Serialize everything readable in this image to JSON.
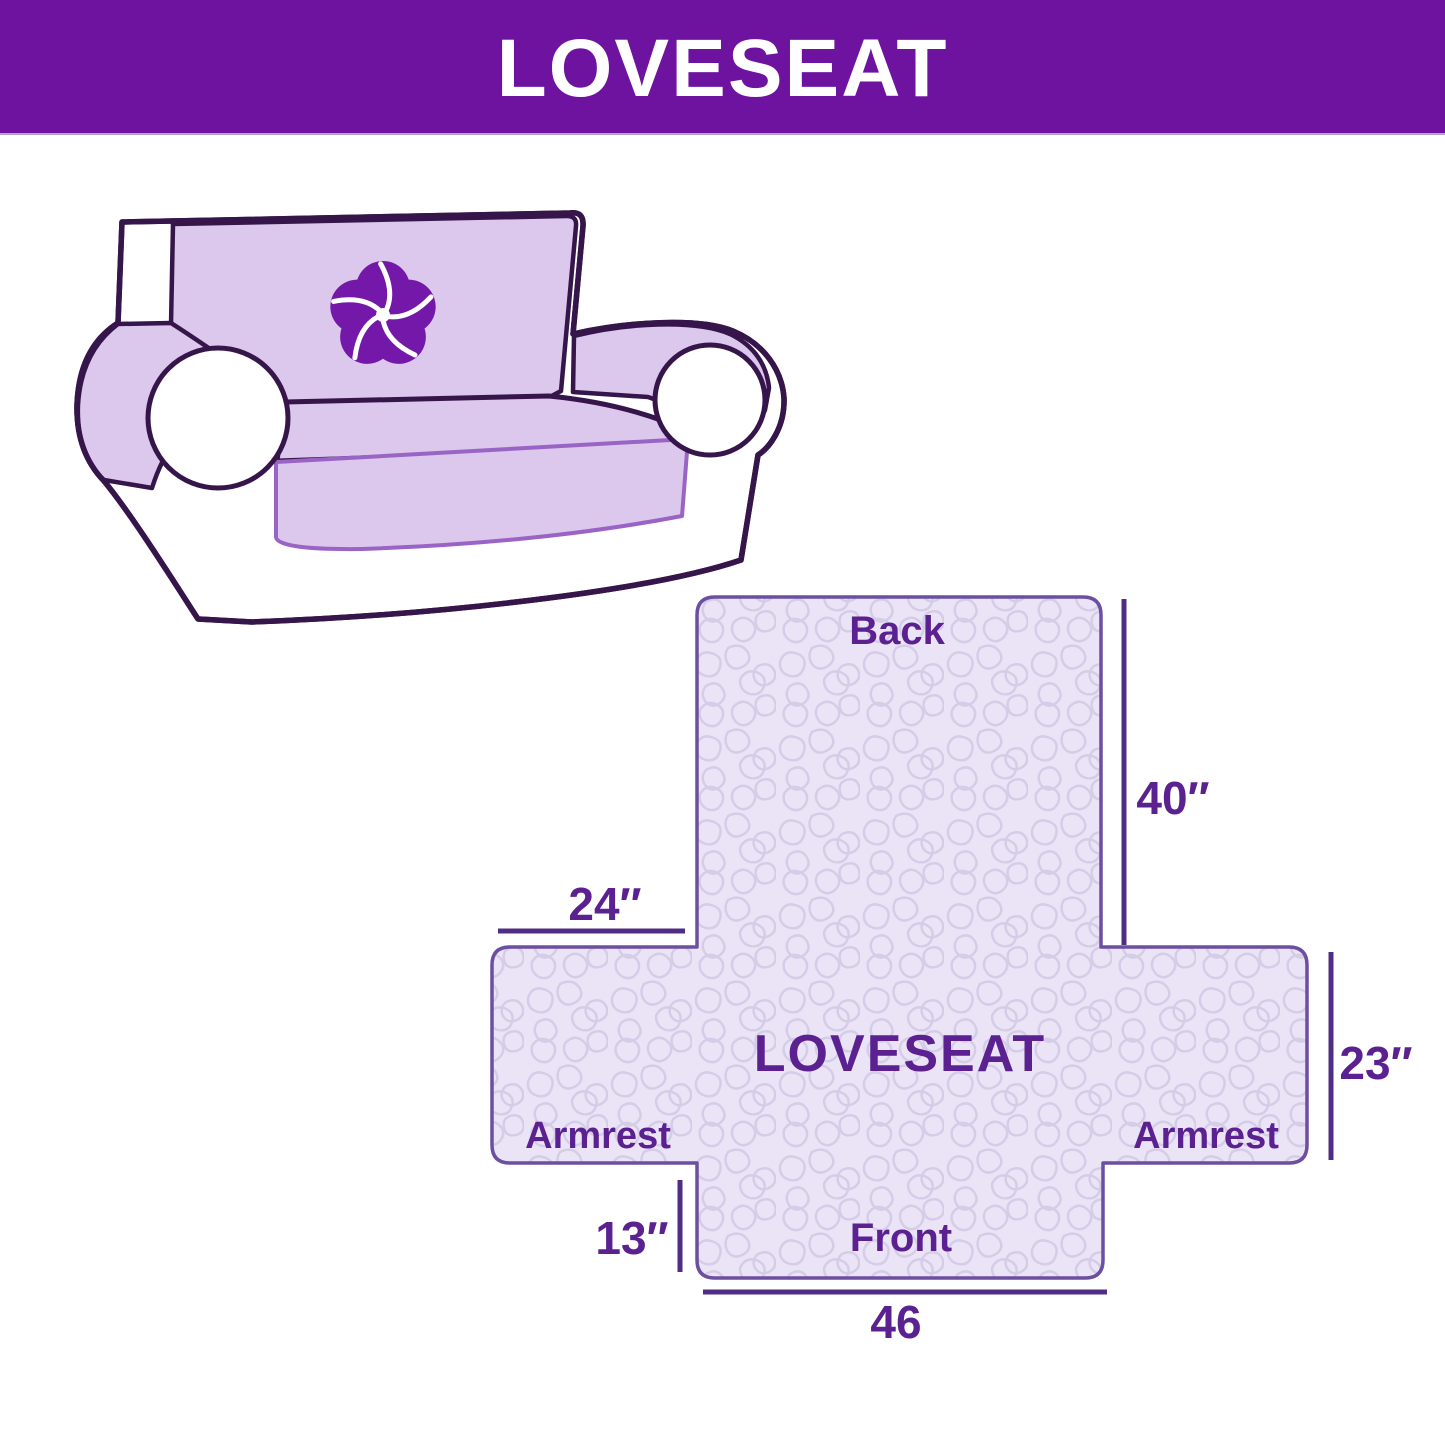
{
  "header": {
    "title": "LOVESEAT"
  },
  "sofa": {
    "logo_icon": "pinwheel-icon"
  },
  "diagram": {
    "back_label": "Back",
    "center_label": "LOVESEAT",
    "armrest_left_label": "Armrest",
    "armrest_right_label": "Armrest",
    "front_label": "Front",
    "dim_back_height": "40″",
    "dim_back_width": "24″",
    "dim_armrest_height": "23″",
    "dim_front_drop": "13″",
    "dim_front_width": "46"
  },
  "colors": {
    "header_bg": "#6e13a0",
    "header_text": "#ffffff",
    "label_text": "#5b2191",
    "dimension_line": "#4f2d85",
    "shape_border": "#6b4fa0",
    "cover_fill": "#eae4f6",
    "pattern_line": "#d5cce8",
    "sofa_outline": "#35154a",
    "sofa_cover": "#dcc7ed",
    "apron_outline": "#9a63c6",
    "logo_purple": "#7318a8"
  }
}
